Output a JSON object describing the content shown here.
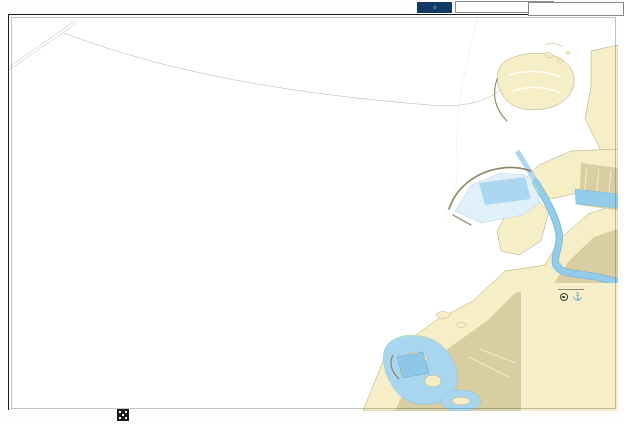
{
  "page": {
    "print_code": "T1HC",
    "top_datum": "WGS84",
    "admiralty_logo": "ADMIRALTY",
    "bottom_datum": "WGS84",
    "chart_number": "3414"
  },
  "title_block": {
    "country": "UNITED ARAB EMIRATES",
    "title_line1": "DUBAI (DUBAYY)",
    "title_conj": "AND",
    "title_line2": "APPROACHES",
    "depths_note": "DEPTHS IN METRES",
    "scale_note": "SCALE 1:25 000"
  },
  "map": {
    "labels": [
      {
        "name": "label-palm-deira",
        "text": "Palm Deira",
        "x": 414,
        "y": 33,
        "size": 3.4,
        "color": "#5a5a52",
        "italic": false,
        "spacing": 0.5
      },
      {
        "name": "label-palm-deira-note1",
        "text": "(under construction)",
        "x": 414,
        "y": 37.8,
        "size": 2.7,
        "color": "#6b6b62",
        "italic": true,
        "spacing": 0
      },
      {
        "name": "label-palm-deira-note2",
        "text": "(2007)",
        "x": 414,
        "y": 42,
        "size": 2.7,
        "color": "#6b6b62",
        "italic": true,
        "spacing": 0
      },
      {
        "name": "label-palm-deira-note3",
        "text": "see Note",
        "x": 414,
        "y": 46.2,
        "size": 2.7,
        "color": "#6b6b62",
        "italic": true,
        "spacing": 0
      },
      {
        "name": "label-anchorage",
        "text": "Anchorage",
        "x": 344,
        "y": 34,
        "size": 3,
        "color": "#7c8894",
        "italic": true,
        "spacing": 0.3
      },
      {
        "name": "label-port-rashid",
        "text": "Port Rashid",
        "x": 488,
        "y": 212,
        "size": 3,
        "color": "#8a959f",
        "italic": false,
        "spacing": 1
      },
      {
        "name": "label-the-world",
        "text": "The World Project",
        "x": 80,
        "y": 282,
        "size": 3.2,
        "color": "#6b6b60",
        "italic": false,
        "spacing": 0.8
      },
      {
        "name": "label-the-world-note1",
        "text": "(under construction)",
        "x": 80,
        "y": 287,
        "size": 2.6,
        "color": "#75756a",
        "italic": true,
        "spacing": 0
      },
      {
        "name": "label-the-world-note2",
        "text": "(2007)",
        "x": 80,
        "y": 291.4,
        "size": 2.6,
        "color": "#75756a",
        "italic": true,
        "spacing": 0
      },
      {
        "name": "label-the-world-note3",
        "text": "see Note",
        "x": 80,
        "y": 295.8,
        "size": 2.6,
        "color": "#75756a",
        "italic": true,
        "spacing": 0
      }
    ]
  }
}
